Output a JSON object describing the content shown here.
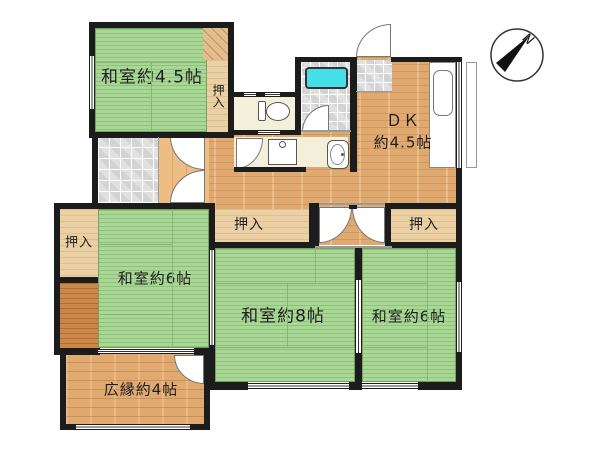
{
  "rooms": {
    "washitsu_45": {
      "label": "和室約4.5帖"
    },
    "dk": {
      "label_line1": "ＤＫ",
      "label_line2": "約4.5帖"
    },
    "washitsu_6_left": {
      "label": "和室約6帖"
    },
    "washitsu_8": {
      "label": "和室約8帖"
    },
    "washitsu_6_right": {
      "label": "和室約6帖"
    },
    "hiroen": {
      "label": "広縁約4帖"
    }
  },
  "closets": {
    "top_left": {
      "label": "押入"
    },
    "left": {
      "label": "押入"
    },
    "center": {
      "label": "押入"
    },
    "right": {
      "label": "押入"
    }
  },
  "compass": {
    "north_label": "N"
  },
  "fixtures": {
    "bathtub": "bathtub",
    "toilet": "toilet",
    "washbasin": "washbasin",
    "laundry_sink": "laundry-sink",
    "kitchen_counter": "kitchen-counter",
    "kitchen_sink": "kitchen-sink"
  },
  "colors": {
    "wall": "#1c1c1c",
    "tatami": "#a9d795",
    "wood": "#e0a970",
    "closet": "#ead0a4",
    "tokonoma": "#ca8748",
    "tile": "#e0e0e0",
    "cream": "#f4efda",
    "bathtub": "#45dfe8"
  }
}
